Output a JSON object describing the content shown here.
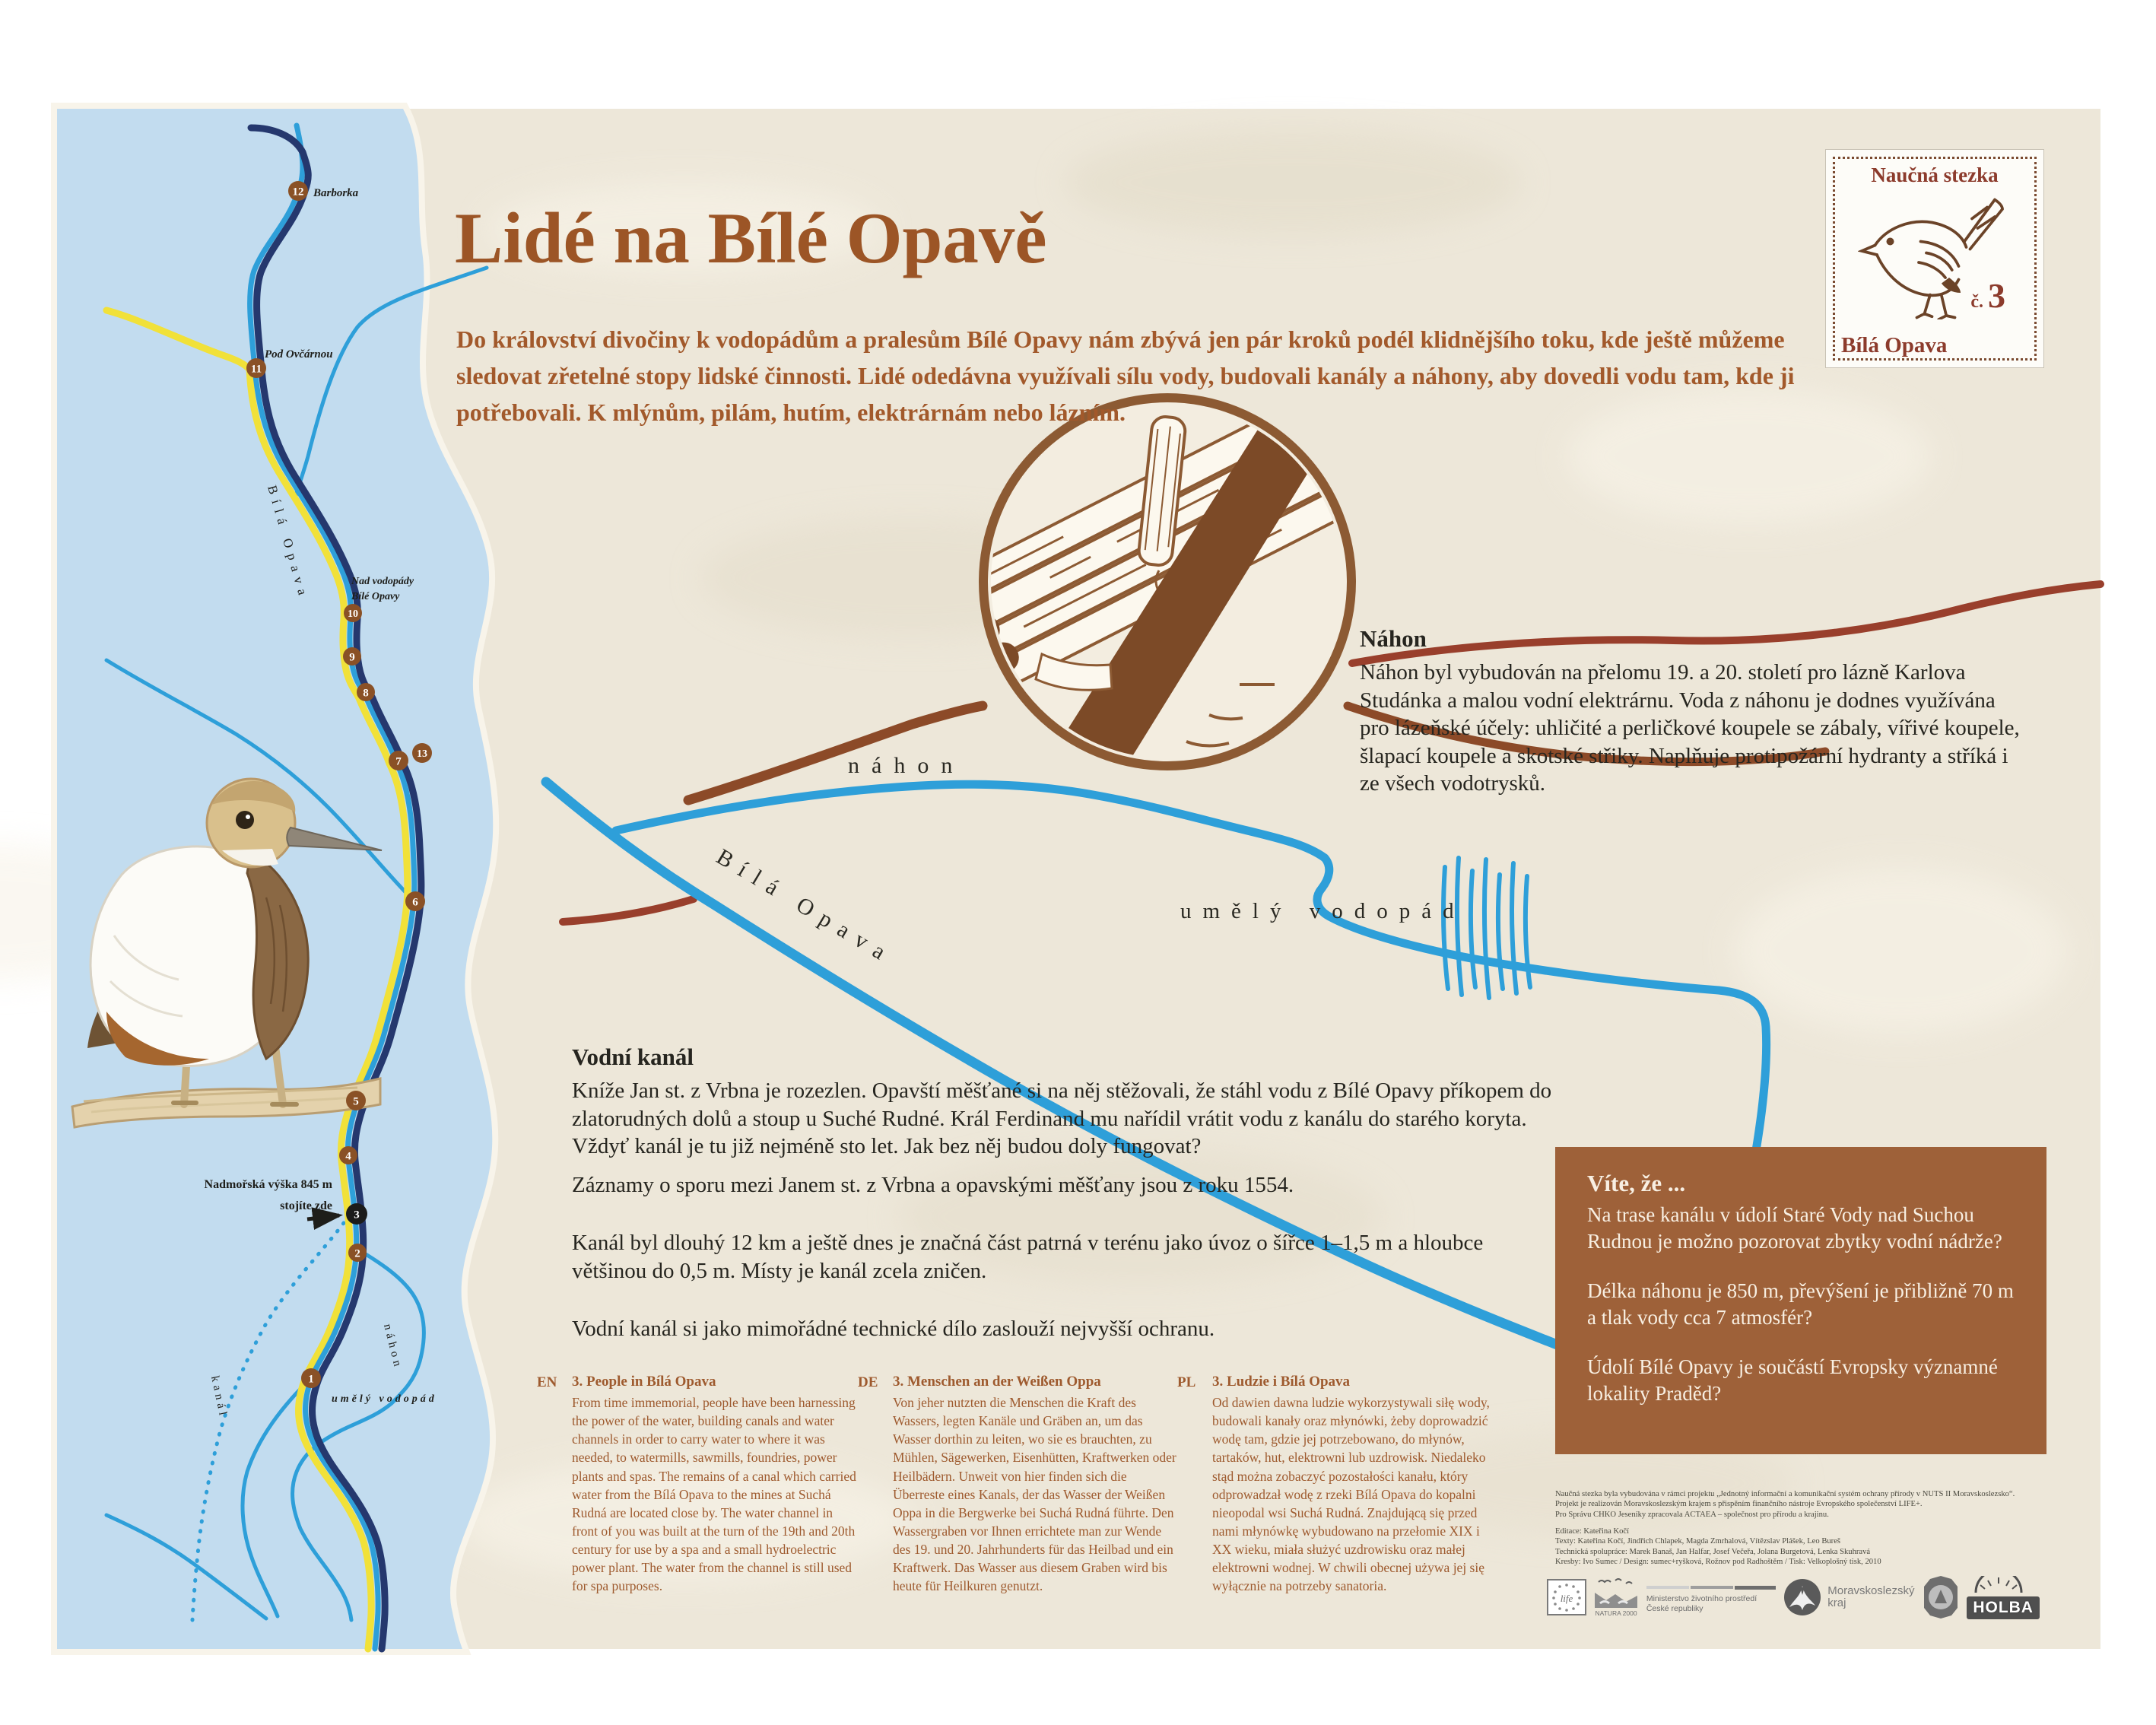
{
  "poster": {
    "title": "Lidé na Bílé Opavě",
    "intro": "Do království divočiny k vodopádům a pralesům Bílé Opavy nám zbývá jen pár kroků podél klidnějšího toku, kde ještě můžeme sledovat zřetelné stopy lidské činnosti. Lidé odedávna využívali sílu vody, budovali kanály a náhony, aby dovedli vodu tam, kde ji potřebovali. K mlýnům, pilám, hutím, elektrárnám nebo lázním."
  },
  "stamp": {
    "top": "Naučná stezka",
    "number_prefix": "č.",
    "number": "3",
    "bottom": "Bílá Opava"
  },
  "nahon": {
    "heading": "Náhon",
    "body": "Náhon byl vybudován na přelomu 19. a 20. století pro lázně Karlova Studánka a malou vodní elektrárnu. Voda z náhonu je dodnes využívána pro lázeňské účely: uhličité a perličkové koupele se zábaly, vířivé koupele, šlapací koupele a skotské střiky. Naplňuje protipožární hydranty a stříká i ze všech vodotrysků."
  },
  "vodni_kanal": {
    "heading": "Vodní kanál",
    "p1": "Kníže Jan st. z Vrbna je rozezlen. Opavští měšťané si na něj stěžovali, že stáhl vodu z Bílé Opavy příkopem do zlatorudných dolů a stoup u Suché Rudné. Král Ferdinand mu nařídil vrátit vodu z kanálu do starého koryta. Vždyť kanál je tu již nejméně sto let. Jak bez něj budou doly fungovat?",
    "p2": "Záznamy o sporu mezi Janem st. z Vrbna a opavskými měšťany jsou z roku 1554.",
    "p3": "Kanál byl dlouhý 12 km a ještě dnes je značná část patrná v terénu jako úvoz o šířce 1–1,5 m a hloubce většinou do 0,5 m. Místy je kanál zcela zničen.",
    "p4": "Vodní kanál si jako mimořádné technické dílo zaslouží nejvyšší ochranu."
  },
  "vite_ze": {
    "heading": "Víte, že ...",
    "q1": "Na trase kanálu v údolí Staré Vody nad Suchou Rudnou je možno pozorovat zbytky vodní nádrže?",
    "q2": "Délka náhonu je 850 m, převýšení je přibližně 70 m a tlak vody cca 7 atmosfér?",
    "q3": "Údolí Bílé Opavy je součástí Evropsky významné lokality Praděd?"
  },
  "translations": [
    {
      "lang": "EN",
      "heading": "3. People in Bílá Opava",
      "body": "From time immemorial, people have been harnessing the power of the water, building canals and water channels in order to carry water to where it was needed, to watermills, sawmills, foundries, power plants and spas. The remains of a canal which carried water from the Bílá Opava to the mines at Suchá Rudná are located close by. The water channel in front of you was built at the turn of the 19th and 20th century for use by a spa and a small hydroelectric power plant. The water from the channel is still used for spa purposes."
    },
    {
      "lang": "DE",
      "heading": "3. Menschen an der Weißen Oppa",
      "body": "Von jeher nutzten die Menschen die Kraft des Wassers, legten Kanäle und Gräben an, um das Wasser dorthin zu leiten, wo sie es brauchten, zu Mühlen, Sägewerken, Eisenhütten, Kraftwerken oder Heilbädern. Unweit von hier finden sich die Überreste eines Kanals, der das Wasser der Weißen Oppa in die Bergwerke bei Suchá Rudná führte. Den Wassergraben vor Ihnen errichtete man zur Wende des 19. und 20. Jahrhunderts für das Heilbad und ein Kraftwerk. Das Wasser aus diesem Graben wird bis heute für Heilkuren genutzt."
    },
    {
      "lang": "PL",
      "heading": "3. Ludzie i Bílá Opava",
      "body": "Od dawien dawna ludzie wykorzystywali siłę wody, budowali kanały oraz młynówki, żeby doprowadzić wodę tam, gdzie jej potrzebowano, do młynów, tartaków, hut, elektrowni lub uzdrowisk. Niedaleko stąd można zobaczyć pozostałości kanału, który odprowadzał wodę z rzeki Bílá Opava do kopalni nieopodal wsi Suchá Rudná. Znajdującą się przed nami młynówkę wybudowano na przełomie XIX i XX wieku, miała służyć uzdrowisku oraz małej elektrowni wodnej. W chwili obecnej używa jej się wyłącznie na potrzeby sanatoria."
    }
  ],
  "credits": {
    "line1": "Naučná stezka byla vybudována v rámci projektu „Jednotný informační a komunikační systém ochrany přírody v NUTS II Moravskoslezsko“.",
    "line2": "Projekt je realizován Moravskoslezským krajem s přispěním finančního nástroje Evropského společenství LIFE+.",
    "line3": "Pro Správu CHKO Jeseníky zpracovala ACTAEA – společnost pro přírodu a krajinu.",
    "line4": "Editace: Kateřina Kočí",
    "line5": "Texty: Kateřina Kočí, Jindřich Chlapek, Magda Zmrhalová, Vítězslav Plášek, Leo Bureš",
    "line6": "Technická spolupráce: Marek Banaš, Jan Halfar, Josef Večeřa, Jolana Burgetová, Lenka Skuhravá",
    "line7": "Kresby: Ivo Sumec / Design: sumec+ryšková, Rožnov pod Radhoštěm / Tisk: Velkoplošný tisk, 2010"
  },
  "logos": {
    "life": "life",
    "natura": "NATURA 2000",
    "mzp_l1": "Ministerstvo životního prostředí",
    "mzp_l2": "České republiky",
    "msk_l1": "Moravskoslezský",
    "msk_l2": "kraj",
    "holba": "HOLBA"
  },
  "map": {
    "stops": {
      "s1": "1",
      "s2": "2",
      "s3": "3",
      "s4": "4",
      "s5": "5",
      "s6": "6",
      "s7": "7",
      "s8": "8",
      "s9": "9",
      "s10": "10",
      "s11": "11",
      "s12": "12",
      "s13": "13"
    },
    "labels": {
      "barborka": "Barborka",
      "pod_ovcarnou": "Pod Ovčárnou",
      "nad_vodopady_1": "Nad vodopády",
      "nad_vodopady_2": "Bílé Opavy",
      "bila_opava": "Bílá Opava",
      "nahon": "náhon",
      "kanal": "kanál",
      "umely_vodopad": "umělý vodopád",
      "altitude": "Nadmořská výška 845 m",
      "you_are_here": "stojíte zde"
    }
  },
  "drawing": {
    "nahon": "náhon",
    "bila_opava": "Bílá Opava",
    "umely_vodopad": "umělý vodopád"
  }
}
